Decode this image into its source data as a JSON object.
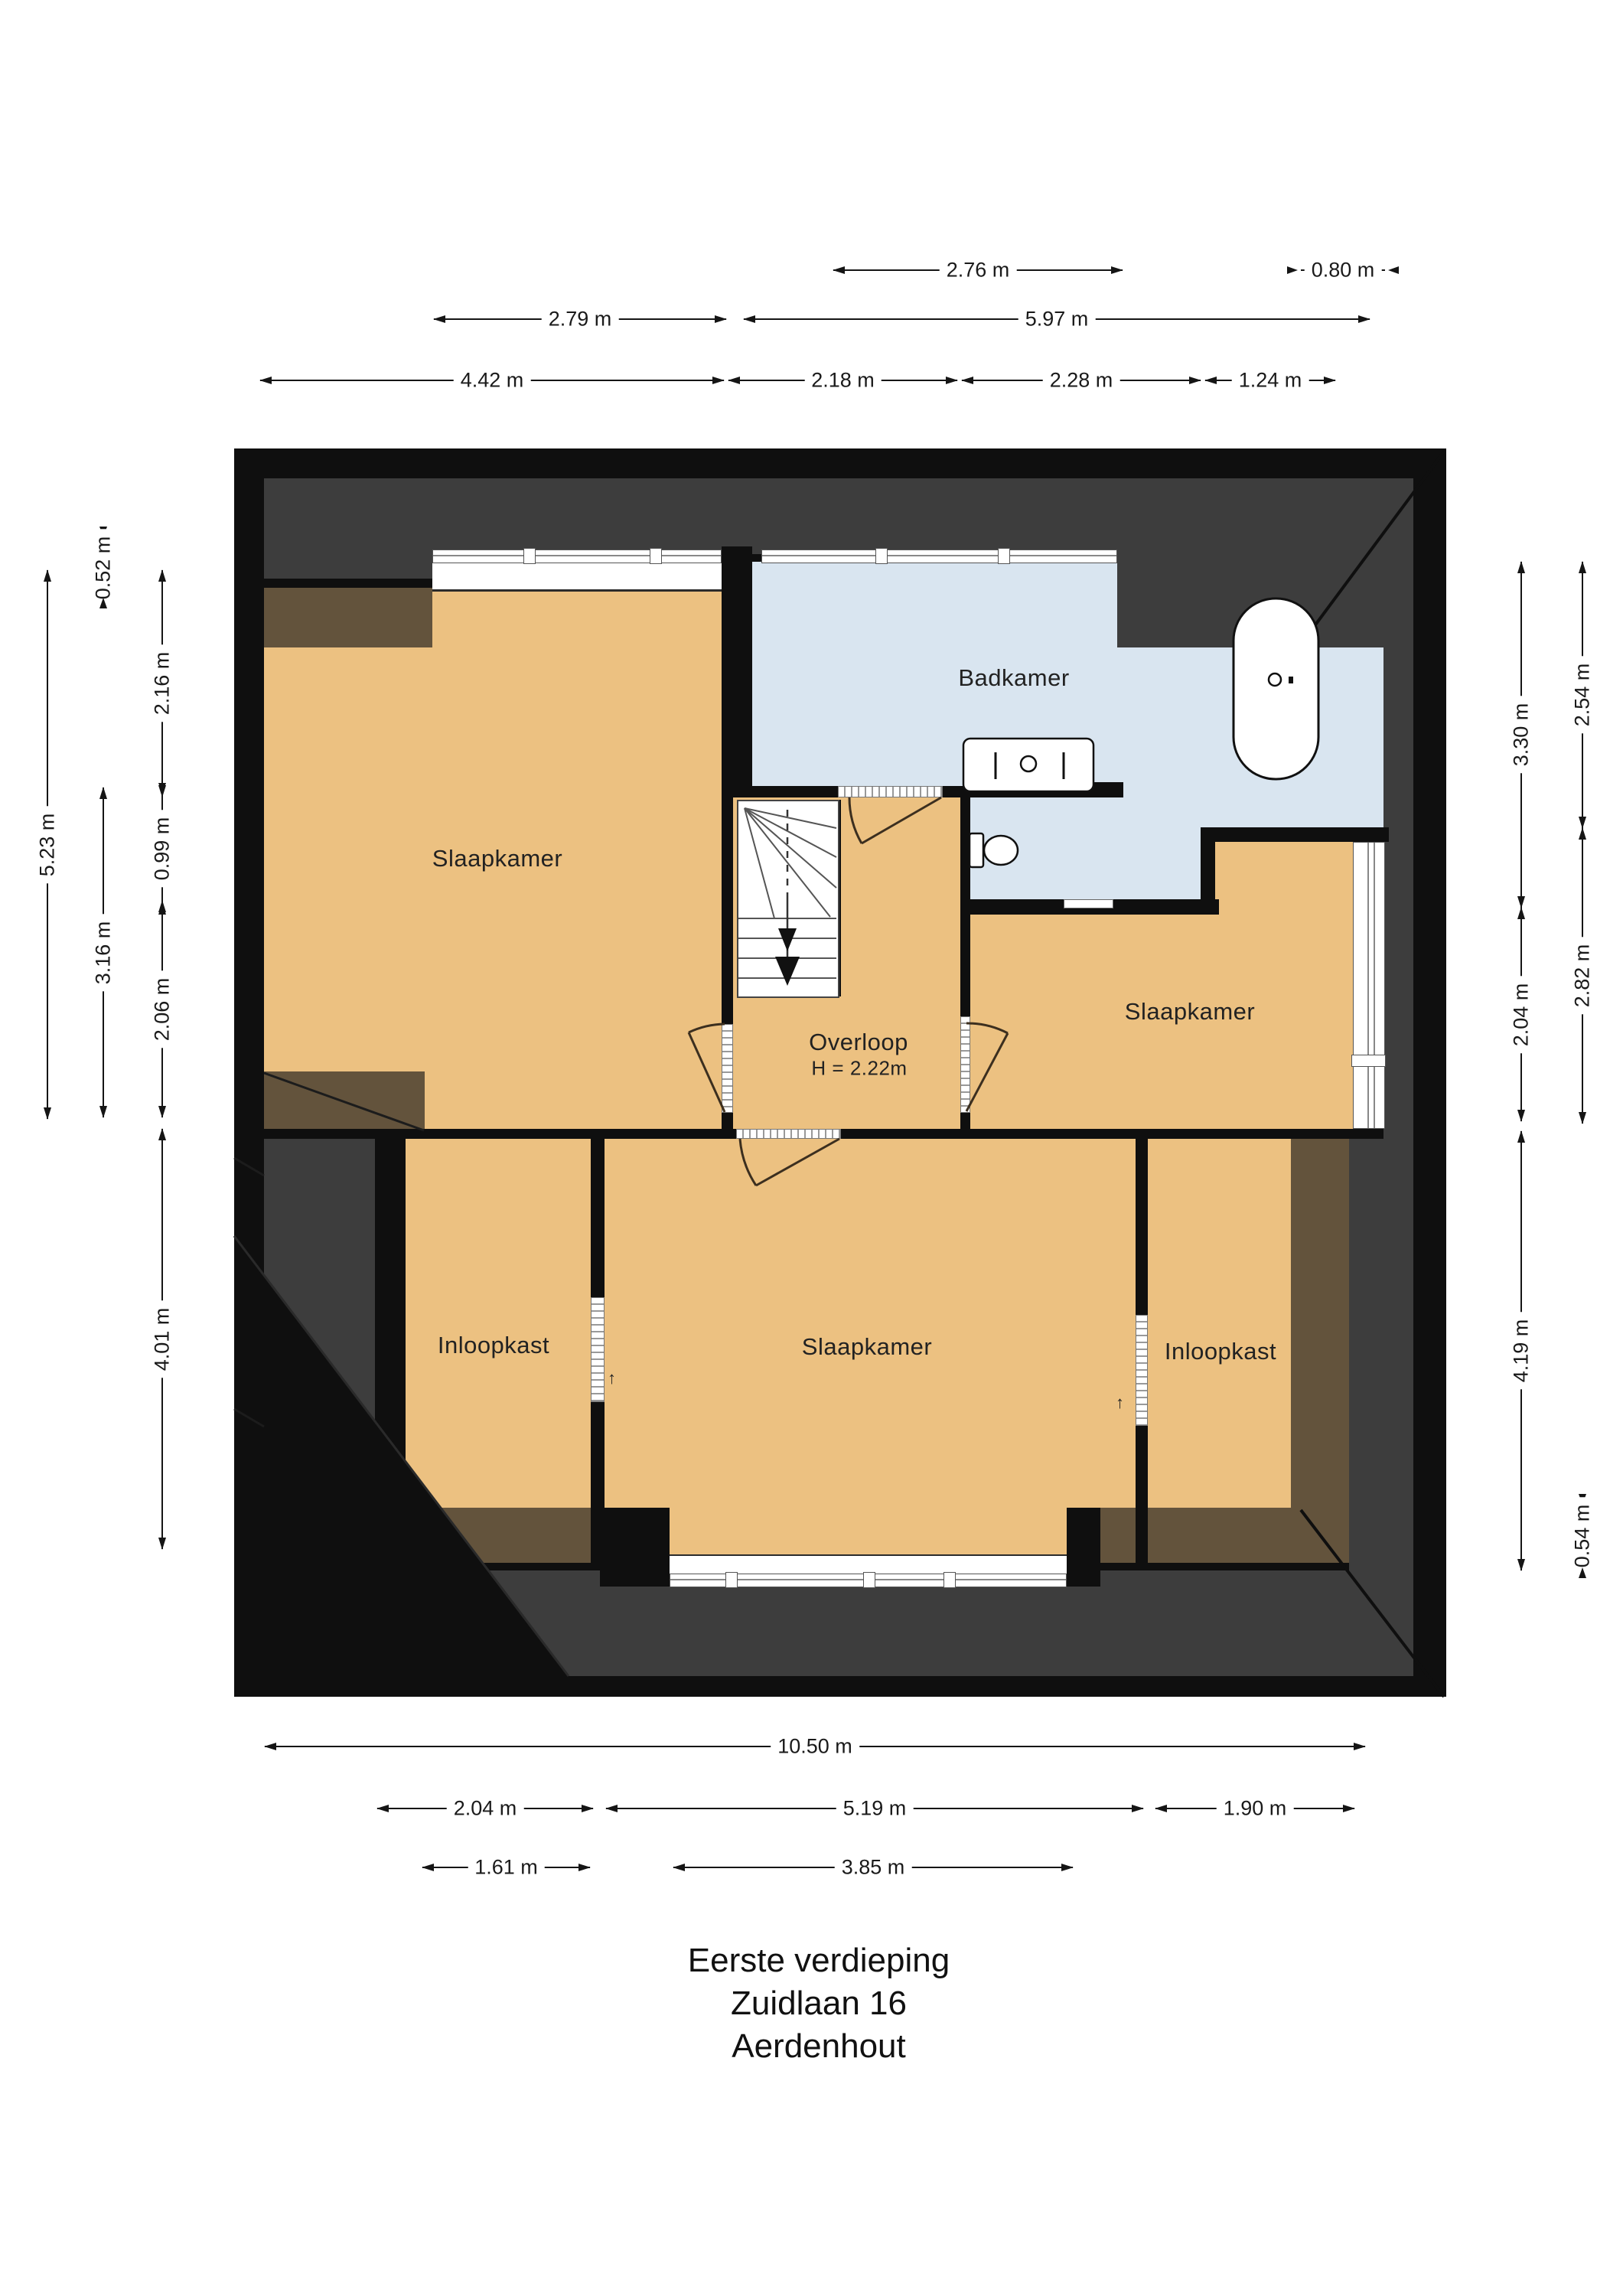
{
  "title": {
    "line1": "Eerste verdieping",
    "line2": "Zuidlaan 16",
    "line3": "Aerdenhout"
  },
  "rooms": {
    "bedroom_topleft": "Slaapkamer",
    "bathroom": "Badkamer",
    "landing": "Overloop",
    "landing_height": "H = 2.22m",
    "bedroom_right": "Slaapkamer",
    "bedroom_bottom": "Slaapkamer",
    "closet_left": "Inloopkast",
    "closet_right": "Inloopkast"
  },
  "dimensions": {
    "top_276": "2.76 m",
    "top_080": "0.80 m",
    "top_279": "2.79 m",
    "top_597": "5.97 m",
    "top_442": "4.42 m",
    "top_218": "2.18 m",
    "top_228": "2.28 m",
    "top_124": "1.24 m",
    "left_523": "5.23 m",
    "left_052": "0.52 m",
    "left_316": "3.16 m",
    "left_216": "2.16 m",
    "left_099": "0.99 m",
    "left_206": "2.06 m",
    "left_401": "4.01 m",
    "right_330": "3.30 m",
    "right_204": "2.04 m",
    "right_419": "4.19 m",
    "right_254": "2.54 m",
    "right_282": "2.82 m",
    "right_054": "0.54 m",
    "bottom_1050": "10.50 m",
    "bottom_204": "2.04 m",
    "bottom_519": "5.19 m",
    "bottom_190": "1.90 m",
    "bottom_161": "1.61 m",
    "bottom_385": "3.85 m"
  },
  "markers": {
    "door_up_left": "↑",
    "door_up_right": "↑"
  },
  "colors": {
    "wall": "#0f0f0f",
    "roof": "#3d3d3d",
    "room": "#ecc181",
    "bath": "#d9e5f0",
    "shade": "#63533c"
  }
}
